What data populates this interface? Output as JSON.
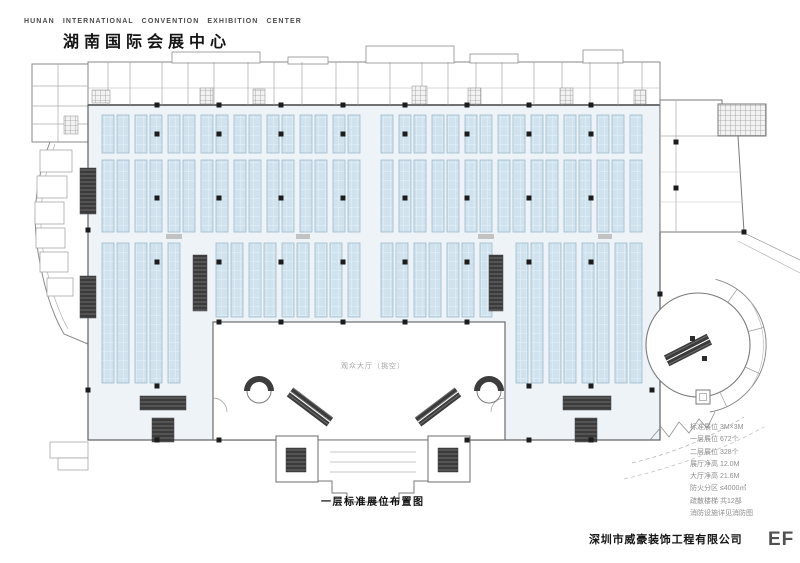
{
  "header": {
    "english": "HUNAN INTERNATIONAL CONVENTION EXHIBITION CENTER",
    "title": "湖南国际会展中心"
  },
  "caption": "一层标准展位布置图",
  "plan_labels": {
    "lobby": "观众大厅（挑空）"
  },
  "legend": {
    "rows": [
      "标准展位 3M×3M",
      "一层展位 672个",
      "二层展位 328个",
      "展厅净高 12.0M",
      "大厅净高 21.6M",
      "防火分区 ≤4000㎡",
      "疏散楼梯 共12部",
      "消防设施详见消防图"
    ]
  },
  "footer": {
    "company": "深圳市威豪装饰工程有限公司",
    "sheet": "EF"
  },
  "colors": {
    "booth_fill": "#cfe2ee",
    "booth_grid_line": "#e9f2f8",
    "booth_border": "#9db9cc",
    "hall_floor": "#eef3f8",
    "wall": "#5e5e5e",
    "dark_core": "#3b3b3b",
    "dot": "#1c1c1c"
  },
  "floor_plan": {
    "col_w": 12,
    "col_gap": 3,
    "aisle": 6,
    "wide_aisles": [
      [
        362,
        380
      ]
    ],
    "bands": [
      {
        "y": 115,
        "h": 38,
        "x1": 102,
        "x2": 648
      },
      {
        "y": 160,
        "h": 72,
        "x1": 102,
        "x2": 648
      },
      {
        "y": 243,
        "h": 140,
        "x1": 102,
        "x2": 190
      },
      {
        "y": 243,
        "h": 74,
        "x1": 216,
        "x2": 502
      },
      {
        "y": 243,
        "h": 140,
        "x1": 516,
        "x2": 648
      }
    ],
    "dots": {
      "xs": [
        157,
        219,
        281,
        343,
        405,
        467,
        529,
        591
      ],
      "rows": [
        {
          "y": 105
        },
        {
          "y": 134
        },
        {
          "y": 198
        },
        {
          "y": 262
        },
        {
          "y": 322,
          "min": 214,
          "max": 504
        },
        {
          "y": 386,
          "only": [
            157,
            529,
            591
          ]
        },
        {
          "y": 440,
          "only": [
            157,
            219,
            467,
            529,
            591
          ]
        }
      ]
    },
    "extra_dots": [
      [
        676,
        142
      ],
      [
        676,
        188
      ],
      [
        744,
        232
      ],
      [
        660,
        294
      ],
      [
        652,
        390
      ],
      [
        88,
        230
      ],
      [
        88,
        390
      ]
    ],
    "dark_blocks": [
      [
        80,
        168,
        16,
        46
      ],
      [
        80,
        276,
        16,
        42
      ],
      [
        193,
        255,
        14,
        56
      ],
      [
        489,
        255,
        14,
        56
      ],
      [
        140,
        396,
        46,
        14
      ],
      [
        563,
        396,
        48,
        14
      ],
      [
        152,
        418,
        22,
        24
      ],
      [
        575,
        418,
        22,
        24
      ],
      [
        286,
        448,
        20,
        24
      ],
      [
        438,
        448,
        20,
        24
      ]
    ],
    "gray_hatches": [
      [
        200,
        88,
        13,
        16
      ],
      [
        253,
        89,
        12,
        15
      ],
      [
        412,
        86,
        15,
        18
      ],
      [
        468,
        88,
        13,
        16
      ],
      [
        560,
        88,
        13,
        16
      ],
      [
        634,
        90,
        12,
        14
      ],
      [
        64,
        116,
        14,
        18
      ],
      [
        92,
        90,
        18,
        13
      ]
    ],
    "top_partitions": [
      108,
      130,
      162,
      188,
      214,
      248,
      274,
      302,
      336,
      358,
      390,
      422,
      448,
      476,
      502,
      534,
      562,
      590,
      618,
      642
    ],
    "bumps": [
      [
        172,
        52,
        88,
        11
      ],
      [
        288,
        57,
        40,
        7
      ],
      [
        366,
        46,
        88,
        17
      ],
      [
        470,
        54,
        48,
        9
      ],
      [
        583,
        50,
        40,
        13
      ]
    ],
    "white_rooms": [
      [
        40,
        150,
        32,
        22
      ],
      [
        37,
        176,
        30,
        22
      ],
      [
        35,
        202,
        29,
        22
      ],
      [
        36,
        228,
        29,
        20
      ],
      [
        40,
        252,
        28,
        20
      ],
      [
        47,
        278,
        26,
        18
      ],
      [
        50,
        442,
        38,
        16
      ],
      [
        58,
        458,
        30,
        12
      ]
    ],
    "aisle_marks": [
      [
        166,
        234,
        16,
        5
      ],
      [
        296,
        234,
        14,
        5
      ],
      [
        478,
        234,
        16,
        5
      ],
      [
        598,
        234,
        14,
        5
      ]
    ]
  }
}
